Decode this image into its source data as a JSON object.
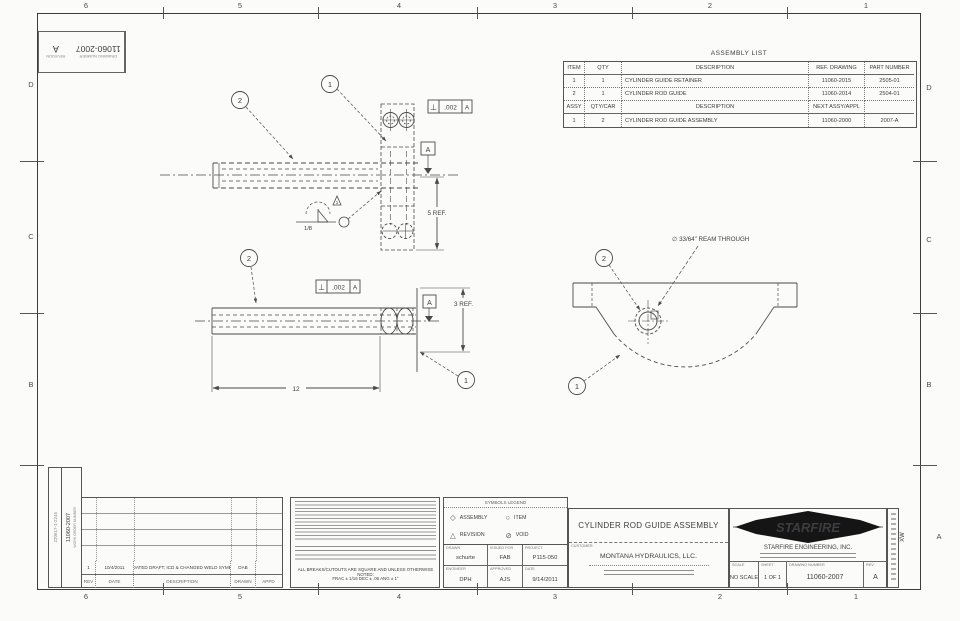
{
  "sheet": {
    "zones_top": [
      "6",
      "5",
      "4",
      "3",
      "2",
      "1"
    ],
    "zones_bottom": [
      "6",
      "5",
      "4",
      "3",
      "2",
      "1"
    ],
    "zones_left": [
      "D",
      "C",
      "B"
    ],
    "zones_right": [
      "D",
      "C",
      "B",
      "A"
    ]
  },
  "corner_stamp": {
    "number": "11060-2007",
    "number_label": "DRAWING NUMBER",
    "rev": "A",
    "rev_label": "REVISION"
  },
  "assembly_list": {
    "title": "ASSEMBLY LIST",
    "header1": [
      "ITEM",
      "QTY",
      "DESCRIPTION",
      "REF. DRAWING",
      "PART NUMBER"
    ],
    "rows1": [
      [
        "1",
        "1",
        "CYLINDER GUIDE RETAINER",
        "11060-2015",
        "2505-01"
      ],
      [
        "2",
        "1",
        "CYLINDER ROD GUIDE",
        "11060-2014",
        "2504-01"
      ]
    ],
    "header2": [
      "ASSY",
      "QTY/CAR",
      "DESCRIPTION",
      "NEXT ASSY/APPL",
      ""
    ],
    "rows2": [
      [
        "1",
        "2",
        "CYLINDER ROD GUIDE ASSEMBLY",
        "11060-2000",
        "2007-A"
      ]
    ]
  },
  "views": {
    "balloon_1": "1",
    "balloon_2": "2",
    "fcf_symbol": "⊥",
    "fcf_tol": ".002",
    "fcf_datum": "A",
    "datum": "A",
    "dim_length": "12",
    "dim_height_side": "3 REF.",
    "dim_height_top": "5 REF.",
    "weld_size": "1/8",
    "weld_flag": "1",
    "ream_note": "∅ 33/64\" REAM THROUGH"
  },
  "revision_history": {
    "headers": [
      "REV",
      "DATE",
      "DESCRIPTION",
      "DRAWN",
      "APPD"
    ],
    "row": {
      "rev": "1",
      "date": "10/4/2011",
      "description": "UPDATED DRAFT; ICD & CHANGED WELD SYMBOL",
      "drawn": "DAB",
      "appd": ""
    }
  },
  "margin": {
    "scan_code": "220617-1-2245",
    "work_order": "11060-2007",
    "work_order_label": "WORK ORDER NUMBER",
    "right_mark": "XW"
  },
  "notes": {
    "footer1": "ALL BREAKS/CUTOUTS ARE SQUARE AND UNLESS OTHERWISE NOTED:",
    "footer2": "FRAC ± 1/16   DEC ± .06   ANG ± 1°"
  },
  "legend": {
    "title": "SYMBOLS LEGEND",
    "items": [
      {
        "icon": "◇",
        "label": "ASSEMBLY"
      },
      {
        "icon": "△",
        "label": "REVISION"
      },
      {
        "icon": "○",
        "label": "ITEM"
      },
      {
        "icon": "⊘",
        "label": "VOID"
      }
    ]
  },
  "signoff": {
    "drawn_label": "DRAWN",
    "drawn": "schurte",
    "issued_label": "ISSUED FOR",
    "issued": "FAB",
    "project_label": "PROJECT",
    "project": "P115-050",
    "engineer_label": "ENGINEER",
    "engineer": "DPH",
    "approved_label": "APPROVED",
    "approved": "AJS",
    "date_label": "DATE",
    "date": "9/14/2011"
  },
  "title_block": {
    "title": "CYLINDER ROD GUIDE ASSEMBLY",
    "customer_label": "CUSTOMER",
    "customer": "MONTANA HYDRAULICS, LLC.",
    "logo_text": "STARFIRE",
    "company": "STARFIRE ENGINEERING, INC.",
    "scale_label": "SCALE",
    "scale": "NO SCALE",
    "sheet_label": "SHEET",
    "sheet": "1 OF 1",
    "dwg_label": "DRAWING NUMBER",
    "dwg": "11060-2007",
    "rev_label": "REV",
    "rev": "A"
  }
}
